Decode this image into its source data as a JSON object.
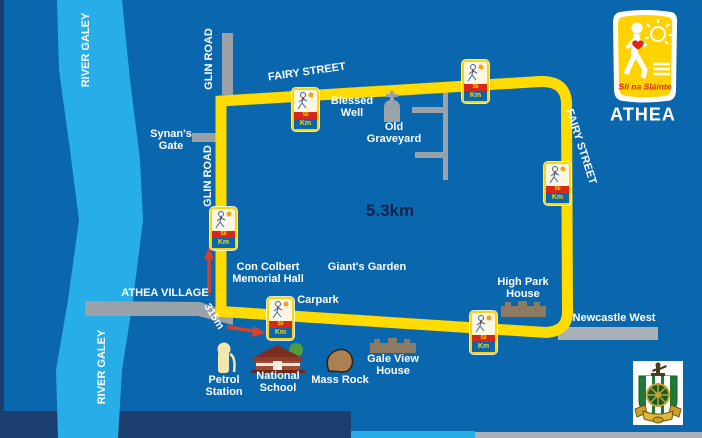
{
  "logo": {
    "name": "Slí na Sláinte",
    "town": "ATHEA"
  },
  "route": {
    "distance": "5.3km",
    "start_offset": "315m"
  },
  "roads": {
    "glin_road": "GLIN ROAD",
    "fairy_street": "FAIRY STREET",
    "athea_village": "ATHEA VILLAGE",
    "newcastle_west": "Newcastle West"
  },
  "river": {
    "name": "RIVER GALEY"
  },
  "places": {
    "synans_gate": {
      "line1": "Synan's",
      "line2": "Gate"
    },
    "blessed_well": {
      "line1": "Blessed",
      "line2": "Well"
    },
    "old_graveyard": {
      "line1": "Old",
      "line2": "Graveyard"
    },
    "con_colbert": {
      "line1": "Con Colbert",
      "line2": "Memorial Hall"
    },
    "carpark": "Carpark",
    "giants_garden": "Giant's Garden",
    "high_park_house": {
      "line1": "High Park",
      "line2": "House"
    },
    "gale_view_house": {
      "line1": "Gale View",
      "line2": "House"
    },
    "mass_rock": "Mass Rock",
    "national_school": {
      "line1": "National",
      "line2": "School"
    },
    "petrol_station": {
      "line1": "Petrol",
      "line2": "Station"
    }
  },
  "km_marker": {
    "sli": "Slí",
    "km": "Km"
  },
  "colors": {
    "background": "#0A67AE",
    "river": "#27AEE9",
    "route_yellow": "#FFDB00",
    "road_gray": "#99A1A9",
    "navy_band": "#1D3F6F",
    "arrow_red": "#D8402C",
    "logo_yellow": "#FFD200",
    "logo_text_red": "#E1251B",
    "distance_text": "#15224E"
  }
}
